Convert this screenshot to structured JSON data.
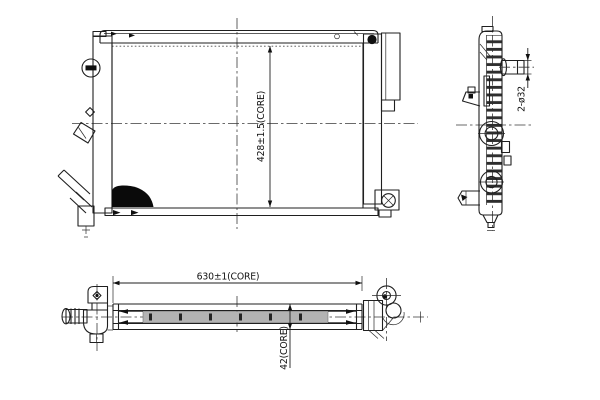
{
  "drawing": {
    "type": "technical-orthographic-views",
    "labels": {
      "core_height": "428±1.5(CORE)",
      "core_width": "630±1(CORE)",
      "core_depth": "42(CORE)",
      "pipe_ports": "2-ø32"
    },
    "colors": {
      "line": "#1f1f1f",
      "background": "#ffffff",
      "solid_fill": "#0a0a0a",
      "core_band": "#b3b3b3"
    }
  }
}
